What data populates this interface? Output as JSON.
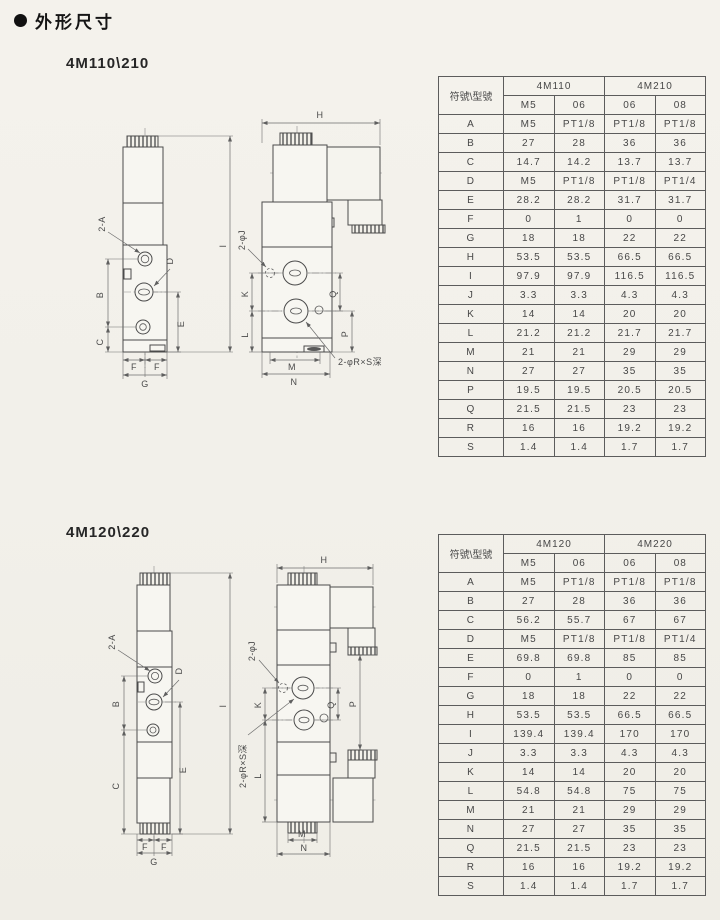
{
  "page": {
    "title": "外形尺寸"
  },
  "sections": [
    {
      "model_label": "4M110\\210",
      "front_labels": {
        "port_a": "2-A",
        "d": "D",
        "b": "B",
        "c": "C",
        "e": "E",
        "f_left": "F",
        "f_right": "F",
        "g": "G",
        "i": "I"
      },
      "side_labels": {
        "h": "H",
        "j_holes": "2-φJ",
        "k": "K",
        "l": "L",
        "q": "Q",
        "p": "P",
        "m": "M",
        "n": "N",
        "r_depth": "2-φR×S深"
      },
      "table": {
        "corner_label": "符號\\型號",
        "groups": [
          {
            "label": "4M110",
            "subcols": [
              "M5",
              "06"
            ]
          },
          {
            "label": "4M210",
            "subcols": [
              "06",
              "08"
            ]
          }
        ],
        "rows": [
          [
            "A",
            "M5",
            "PT1/8",
            "PT1/8",
            "PT1/8"
          ],
          [
            "B",
            "27",
            "28",
            "36",
            "36"
          ],
          [
            "C",
            "14.7",
            "14.2",
            "13.7",
            "13.7"
          ],
          [
            "D",
            "M5",
            "PT1/8",
            "PT1/8",
            "PT1/4"
          ],
          [
            "E",
            "28.2",
            "28.2",
            "31.7",
            "31.7"
          ],
          [
            "F",
            "0",
            "1",
            "0",
            "0"
          ],
          [
            "G",
            "18",
            "18",
            "22",
            "22"
          ],
          [
            "H",
            "53.5",
            "53.5",
            "66.5",
            "66.5"
          ],
          [
            "I",
            "97.9",
            "97.9",
            "116.5",
            "116.5"
          ],
          [
            "J",
            "3.3",
            "3.3",
            "4.3",
            "4.3"
          ],
          [
            "K",
            "14",
            "14",
            "20",
            "20"
          ],
          [
            "L",
            "21.2",
            "21.2",
            "21.7",
            "21.7"
          ],
          [
            "M",
            "21",
            "21",
            "29",
            "29"
          ],
          [
            "N",
            "27",
            "27",
            "35",
            "35"
          ],
          [
            "P",
            "19.5",
            "19.5",
            "20.5",
            "20.5"
          ],
          [
            "Q",
            "21.5",
            "21.5",
            "23",
            "23"
          ],
          [
            "R",
            "16",
            "16",
            "19.2",
            "19.2"
          ],
          [
            "S",
            "1.4",
            "1.4",
            "1.7",
            "1.7"
          ]
        ]
      }
    },
    {
      "model_label": "4M120\\220",
      "front_labels": {
        "port_a": "2-A",
        "d": "D",
        "b": "B",
        "c": "C",
        "e": "E",
        "f_left": "F",
        "f_right": "F",
        "g": "G",
        "i": "I"
      },
      "side_labels": {
        "h": "H",
        "j_holes": "2-φJ",
        "k": "K",
        "l": "L",
        "q": "Q",
        "p": "P",
        "m": "M",
        "n": "N",
        "r_depth": "2-φR×S深"
      },
      "table": {
        "corner_label": "符號\\型號",
        "groups": [
          {
            "label": "4M120",
            "subcols": [
              "M5",
              "06"
            ]
          },
          {
            "label": "4M220",
            "subcols": [
              "06",
              "08"
            ]
          }
        ],
        "rows": [
          [
            "A",
            "M5",
            "PT1/8",
            "PT1/8",
            "PT1/8"
          ],
          [
            "B",
            "27",
            "28",
            "36",
            "36"
          ],
          [
            "C",
            "56.2",
            "55.7",
            "67",
            "67"
          ],
          [
            "D",
            "M5",
            "PT1/8",
            "PT1/8",
            "PT1/4"
          ],
          [
            "E",
            "69.8",
            "69.8",
            "85",
            "85"
          ],
          [
            "F",
            "0",
            "1",
            "0",
            "0"
          ],
          [
            "G",
            "18",
            "18",
            "22",
            "22"
          ],
          [
            "H",
            "53.5",
            "53.5",
            "66.5",
            "66.5"
          ],
          [
            "I",
            "139.4",
            "139.4",
            "170",
            "170"
          ],
          [
            "J",
            "3.3",
            "3.3",
            "4.3",
            "4.3"
          ],
          [
            "K",
            "14",
            "14",
            "20",
            "20"
          ],
          [
            "L",
            "54.8",
            "54.8",
            "75",
            "75"
          ],
          [
            "M",
            "21",
            "21",
            "29",
            "29"
          ],
          [
            "N",
            "27",
            "27",
            "35",
            "35"
          ],
          [
            "Q",
            "21.5",
            "21.5",
            "23",
            "23"
          ],
          [
            "R",
            "16",
            "16",
            "19.2",
            "19.2"
          ],
          [
            "S",
            "1.4",
            "1.4",
            "1.7",
            "1.7"
          ]
        ]
      }
    }
  ]
}
